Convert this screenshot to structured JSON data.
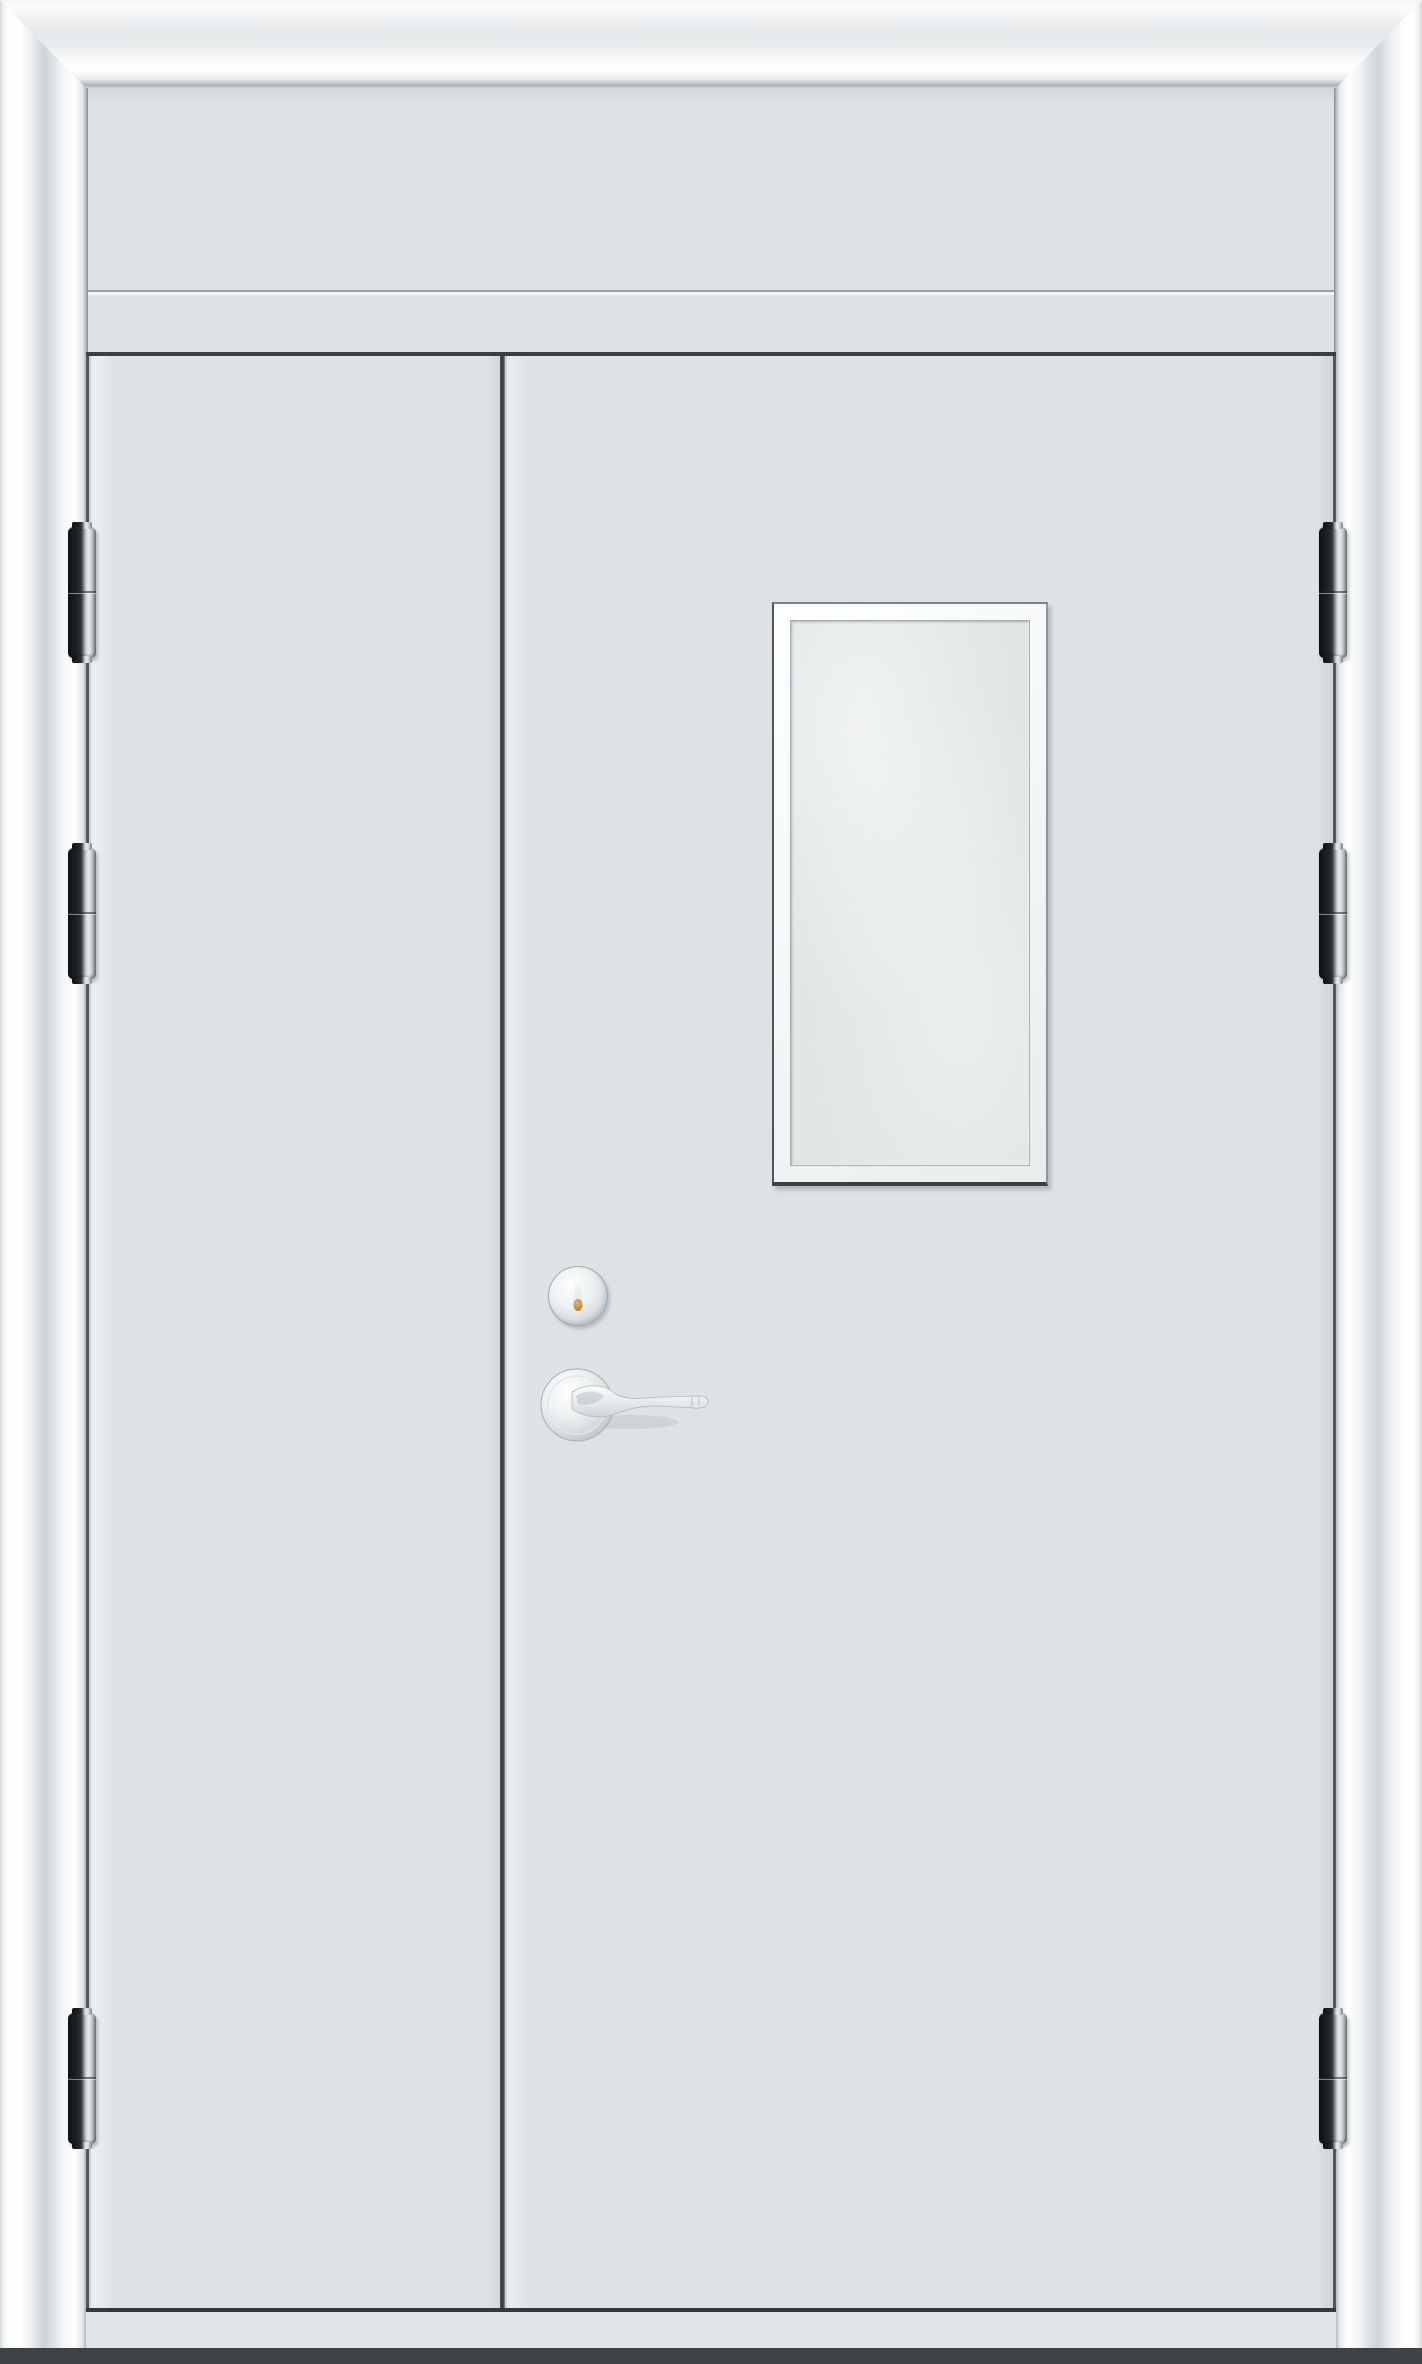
{
  "scene": {
    "description": "Product photo of a white steel unequal double door in a moulded frame with transom panel, vision window, cylinder lock, lever handle and six barrel hinges",
    "background_color": "#dde2e5"
  },
  "colors": {
    "door_surface": "#dde2e5",
    "glass": "#dee5e2",
    "window_trim": "#f8fafa",
    "frame_highlight": "#ffffff",
    "frame_mid": "#ced3d5",
    "frame_edge": "#9fa5a8",
    "trim_gray": "#9aa0a3",
    "line_dark": "#3a3f42",
    "threshold": "#e0e4e6",
    "floor_dark": "#3f4346",
    "hinge_dark": "#1d2123",
    "hinge_metal": "#e9eced",
    "hardware_silver": "#d8dcde",
    "keyhole_brass": "#b06f24"
  },
  "door": {
    "frame": {
      "name": "moulded-architrave-frame",
      "sides": [
        "head",
        "left-jamb",
        "right-jamb"
      ]
    },
    "transom": {
      "name": "transom-panel",
      "trim_lines": 2
    },
    "leaves": [
      {
        "name": "left-leaf",
        "size": "narrow",
        "hinge_count": 3
      },
      {
        "name": "right-leaf",
        "size": "wide",
        "hinge_count": 3,
        "features": [
          "vision-window",
          "cylinder-lock",
          "lever-handle"
        ]
      }
    ],
    "hinges": {
      "count": 6,
      "style": "barrel",
      "finish": "dark-with-steel-knuckle"
    },
    "window": {
      "name": "vision-window",
      "shape": "rectangular",
      "glazing": "frosted"
    },
    "hardware": {
      "lock": "cylinder-with-brass-keyhole",
      "handle": "silver-lever-on-round-rose"
    }
  }
}
